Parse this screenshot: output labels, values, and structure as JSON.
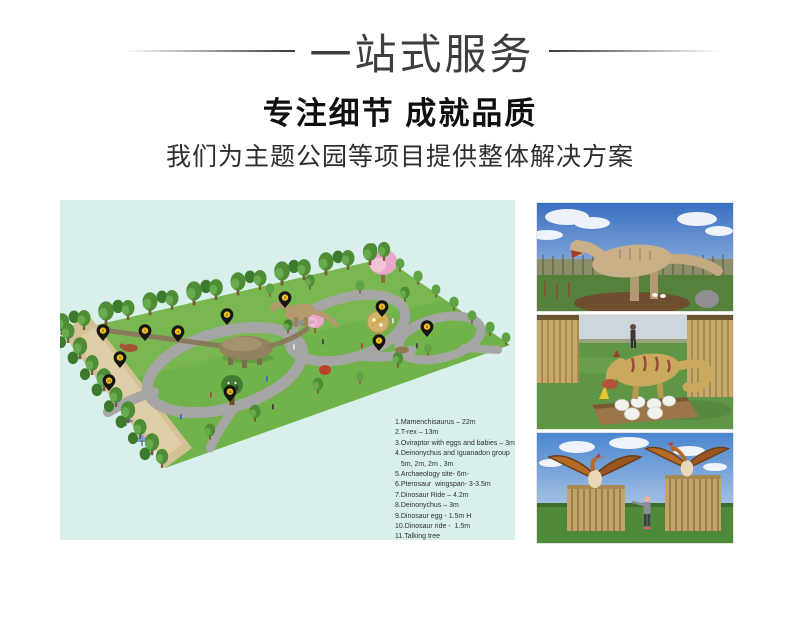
{
  "header": {
    "banner_title": "一站式服务",
    "heading": "专注细节 成就品质",
    "subheading": "我们为主题公园等项目提供整体解决方案"
  },
  "colors": {
    "plan_background": "#d9efec",
    "pin_yellow": "#f2c01d",
    "heading_dark": "#3d3d3d",
    "grass_green": "#72b24a",
    "path_gray": "#a6a6a6",
    "sand_tan": "#d5c196"
  },
  "plan": {
    "legend_lines": [
      "1.Mamenchisaurus – 22m",
      "2.T-rex – 13m",
      "3.Oviraptor with eggs and babies – 3m",
      "4.Deinonychus and Iguanadon group",
      "   5m, 2m, 2m , 3m",
      "5.Archaeology site- 6m-",
      "6.Pterosaur  wingspan- 3-3.5m",
      "7.Dinosaur Ride – 4.2m",
      "8.Deinonychus – 3m",
      "9.Dinosaur egg - 1.5m H",
      "10.Dinosaur ride -  1.5m",
      "11.Talking tree"
    ],
    "pins": [
      {
        "n": 1,
        "x": 85,
        "y": 131
      },
      {
        "n": 2,
        "x": 225,
        "y": 98
      },
      {
        "n": 3,
        "x": 322,
        "y": 107
      },
      {
        "n": 4,
        "x": 118,
        "y": 132
      },
      {
        "n": 5,
        "x": 43,
        "y": 131
      },
      {
        "n": 6,
        "x": 367,
        "y": 127
      },
      {
        "n": 7,
        "x": 319,
        "y": 141
      },
      {
        "n": 8,
        "x": 167,
        "y": 115
      },
      {
        "n": 9,
        "x": 60,
        "y": 158
      },
      {
        "n": 10,
        "x": 49,
        "y": 181
      },
      {
        "n": 11,
        "x": 170,
        "y": 192
      }
    ]
  },
  "photos": [
    {
      "alt": "t-rex-model-photo"
    },
    {
      "alt": "oviraptor-with-eggs-photo"
    },
    {
      "alt": "pterosaur-models-photo"
    }
  ]
}
